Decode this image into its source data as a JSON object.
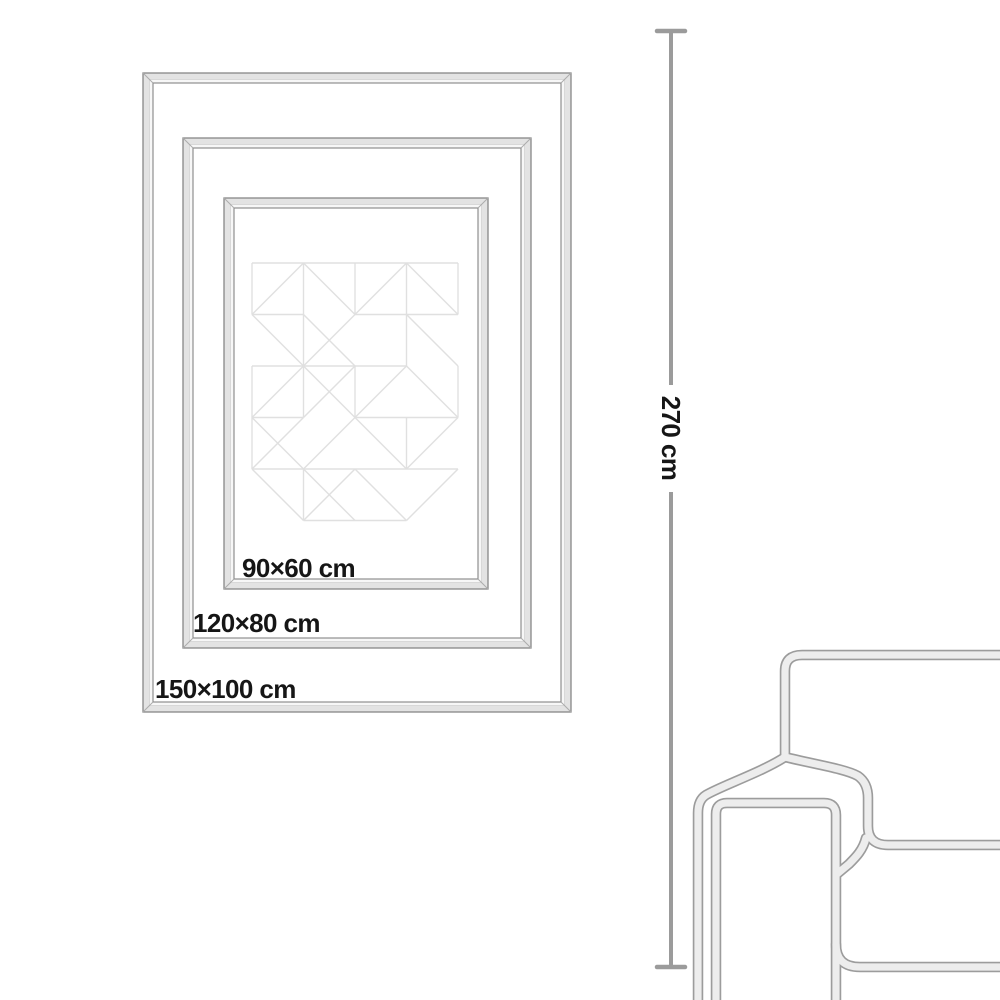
{
  "colors": {
    "background": "#ffffff",
    "text": "#161616",
    "frame_edge": "#878787",
    "frame_band": "#e3e3e3",
    "frame_band_light": "#f7f7f7",
    "frame_inner_edge": "#8f8f8f",
    "frame_miter": "#ababab",
    "artwork_line": "#e0e0e0",
    "measure_line": "#9b9b9b",
    "sofa_edge": "#9c9c9c",
    "sofa_fill": "#ededed"
  },
  "frames": {
    "border_width": 10,
    "items": [
      {
        "label": "150×100 cm",
        "x": 143,
        "y": 73,
        "w": 428,
        "h": 639,
        "label_x": 155,
        "label_y": 698
      },
      {
        "label": "120×80 cm",
        "x": 183,
        "y": 138,
        "w": 348,
        "h": 510,
        "label_x": 193,
        "label_y": 632
      },
      {
        "label": "90×60 cm",
        "x": 224,
        "y": 198,
        "w": 264,
        "h": 391,
        "label_x": 242,
        "label_y": 577
      }
    ]
  },
  "artwork": {
    "x": 252,
    "y": 263,
    "cell": 51.5,
    "cols": 4,
    "rows": 5,
    "segments": [
      [
        0,
        0,
        4,
        0
      ],
      [
        0,
        0,
        0,
        1
      ],
      [
        2,
        0,
        2,
        1
      ],
      [
        4,
        0,
        4,
        1
      ],
      [
        1,
        0,
        1,
        3
      ],
      [
        3,
        0,
        3,
        2
      ],
      [
        0,
        1,
        1,
        0
      ],
      [
        1,
        0,
        2,
        1
      ],
      [
        2,
        1,
        3,
        0
      ],
      [
        3,
        0,
        4,
        1
      ],
      [
        0,
        1,
        1,
        1
      ],
      [
        2,
        1,
        4,
        1
      ],
      [
        0,
        1,
        1,
        2
      ],
      [
        1,
        1,
        2,
        2
      ],
      [
        2,
        1,
        1,
        2
      ],
      [
        3,
        1,
        4,
        2
      ],
      [
        1,
        2,
        2,
        2
      ],
      [
        2,
        2,
        3,
        2
      ],
      [
        0,
        2,
        0,
        4
      ],
      [
        2,
        2,
        2,
        3
      ],
      [
        4,
        2,
        4,
        3
      ],
      [
        0,
        2,
        1,
        2
      ],
      [
        1,
        2,
        0,
        3
      ],
      [
        1,
        2,
        2,
        3
      ],
      [
        2,
        2,
        1,
        3
      ],
      [
        3,
        2,
        2,
        3
      ],
      [
        3,
        2,
        4,
        3
      ],
      [
        0,
        3,
        1,
        3
      ],
      [
        2,
        3,
        4,
        3
      ],
      [
        3,
        3,
        3,
        4
      ],
      [
        0,
        3,
        1,
        4
      ],
      [
        1,
        3,
        0,
        4
      ],
      [
        2,
        3,
        1,
        4
      ],
      [
        2,
        3,
        3,
        4
      ],
      [
        3,
        4,
        4,
        3
      ],
      [
        0,
        4,
        2,
        4
      ],
      [
        2,
        4,
        4,
        4
      ],
      [
        0,
        4,
        1,
        5
      ],
      [
        1,
        4,
        1,
        5
      ],
      [
        1,
        4,
        2,
        5
      ],
      [
        2,
        4,
        1,
        5
      ],
      [
        2,
        4,
        3,
        5
      ],
      [
        3,
        5,
        4,
        4
      ],
      [
        1,
        5,
        3,
        5
      ]
    ]
  },
  "measure": {
    "label": "270 cm",
    "x": 671,
    "top": 31,
    "bottom": 967,
    "gap_top": 385,
    "gap_bottom": 492,
    "cap_half_width": 14,
    "label_cx": 671,
    "label_cy": 438
  },
  "sofa": {
    "paths": {
      "backrest": "M 1002 655 H 802 Q 785 655 785 671 V 757",
      "arm_outer": "M 785 757 C 762 772 721 786 706 795 Q 698 800 698 813 V 1004",
      "arm_front": "M 716 1004 V 814 Q 716 803 727 803 H 824 Q 836 803 836 815 V 1004",
      "seat_top": "M 785 757 C 813 764 846 769 858 776 Q 868 783 868 798 V 826 Q 868 845 888 845 H 1002",
      "seat_diagonal": "M 866 838 C 863 850 856 857 849 864 L 837 874",
      "seat_base": "M 836 944 Q 836 967 860 967 H 1002"
    }
  }
}
